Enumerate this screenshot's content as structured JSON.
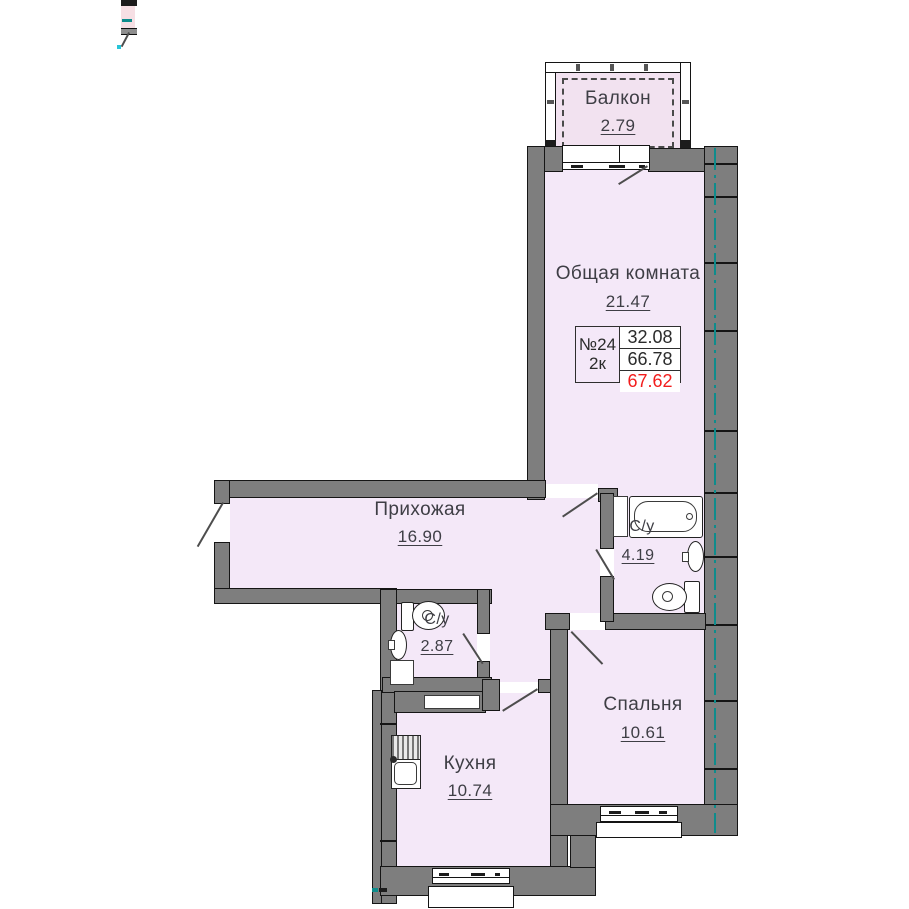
{
  "plan_title": "Floor plan",
  "colors": {
    "room_fill": "#f4e8f8",
    "balcony_fill": "#f2e2f0",
    "wall_gray": "#7e7e7e",
    "axis_teal": "#0e8c8c",
    "text_gray": "#3e3e45",
    "highlight_red": "#f21d1d"
  },
  "unit_info": {
    "number": "№24",
    "type": "2к",
    "rows": [
      "32.08",
      "66.78",
      "67.62"
    ]
  },
  "rooms": {
    "balcony": {
      "name": "Балкон",
      "area": "2.79"
    },
    "living": {
      "name": "Общая комната",
      "area": "21.47"
    },
    "hall": {
      "name": "Прихожая",
      "area": "16.90"
    },
    "bath_main": {
      "name": "С/у",
      "area": "4.19"
    },
    "bath_small": {
      "name": "С/у",
      "area": "2.87"
    },
    "kitchen": {
      "name": "Кухня",
      "area": "10.74"
    },
    "bedroom": {
      "name": "Спальня",
      "area": "10.61"
    }
  }
}
